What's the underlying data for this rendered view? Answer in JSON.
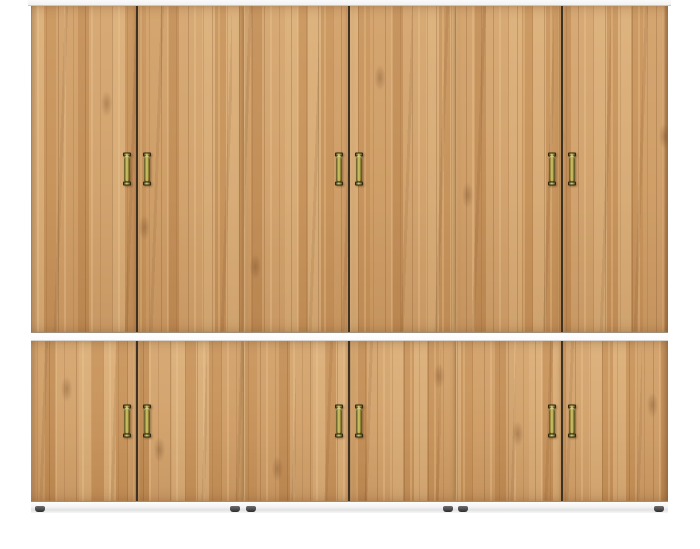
{
  "scene": {
    "description": "Product photo of a wide two-tier wardrobe with twelve oak woodgrain doors, brass pull handles and small dark feet, shown on a plain white background",
    "object": "wardrobe",
    "finish": "golden oak woodgrain",
    "rows": 2,
    "doors_per_row": 6,
    "total_doors": 12,
    "handles_per_row": 6,
    "handle_style": "vertical brass pull with top and bottom caps",
    "feet_visible": 6
  },
  "colors": {
    "page_bg": "#ffffff",
    "wood_base": "#cb9962",
    "wood_light": "#e3bc8d",
    "wood_dark": "#a97c4c",
    "meeting_gap": "#3f3122",
    "pair_gap": "#8e8982",
    "cap_white": "#fafafa",
    "cap_edge": "#c8c8c8",
    "divider_white": "#fbfbfb",
    "divider_edge": "#d8d5d1",
    "plinth_light": "#fdfdfd",
    "plinth_shadow": "#e2e2e2",
    "brass_light": "#d9ce78",
    "brass_mid": "#9a8d3a",
    "brass_dark": "#443d14",
    "foot_light": "#6e6e6e",
    "foot_dark": "#2e2e2e"
  }
}
